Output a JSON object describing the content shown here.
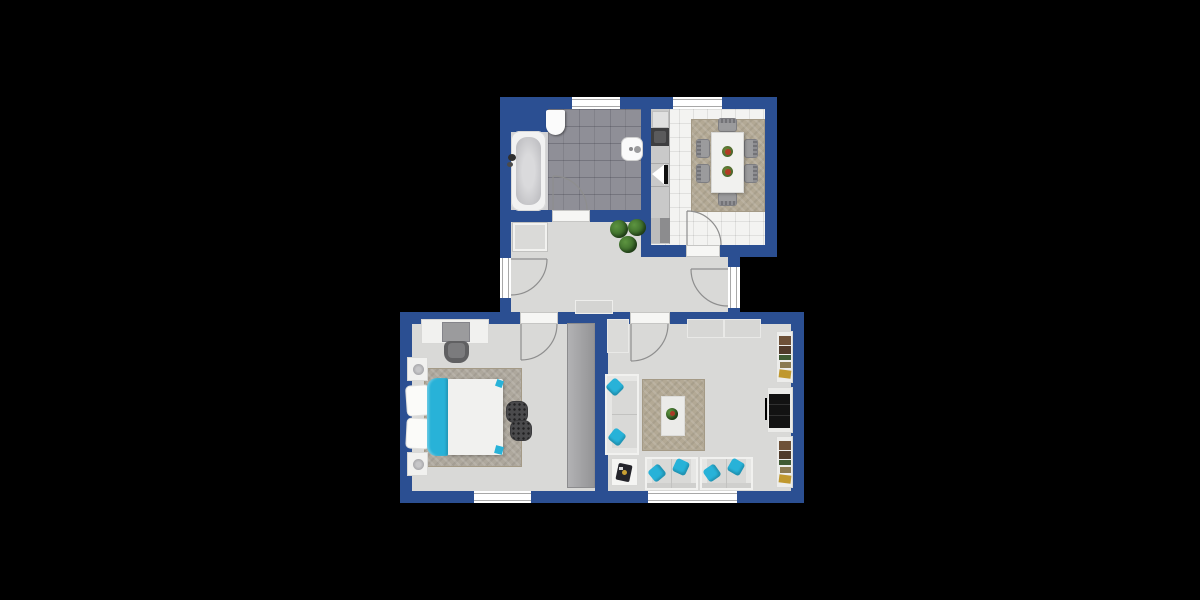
{
  "palette": {
    "background": "#000000",
    "wall": "#2b4f92",
    "floor": "#d9d9d7",
    "bath_tile": "#8f8f97",
    "kitchen_tile": "#f3f3f1",
    "rug": "#b3a995",
    "accent_cyan": "#28b2d8",
    "white_furniture": "#f1f1ef",
    "sofa_gray": "#d9d9d7",
    "dark_gray": "#4a4a4c",
    "plant_green": "#2f5c22",
    "wood_brown": "#6e5138",
    "tv_black": "#121212"
  },
  "plan": {
    "type": "apartment-floor-plan",
    "wall_color_name": "navy-blue",
    "rooms": [
      {
        "name": "bathroom",
        "position": "top-left",
        "floor": "dark-gray-tile",
        "fixtures": [
          "bathtub",
          "pedestal-sink",
          "wall-sink"
        ],
        "windows": 1,
        "doors": 1
      },
      {
        "name": "kitchen-dining",
        "position": "top-right",
        "floor": "white-tile",
        "fixtures": [
          "counter-run",
          "fridge",
          "stove",
          "sink",
          "appliance",
          "dining-table",
          "chairs-x6",
          "table-decor-x2",
          "area-rug"
        ],
        "windows": 1,
        "doors": 1
      },
      {
        "name": "hallway",
        "position": "center",
        "floor": "light-gray",
        "fixtures": [
          "plants-x3",
          "sideboard",
          "storage-cabinet"
        ],
        "exterior_doors": 2
      },
      {
        "name": "bedroom",
        "position": "bottom-left",
        "floor": "light-gray",
        "fixtures": [
          "double-bed",
          "cyan-blanket",
          "pillows-x2",
          "nightstands-x2",
          "lamps-x2",
          "area-rug",
          "poufs-x2",
          "wardrobe",
          "desk",
          "monitor",
          "desk-chair"
        ],
        "windows": 1,
        "doors": 1
      },
      {
        "name": "living-room",
        "position": "bottom-right",
        "floor": "light-gray",
        "fixtures": [
          "wall-sofa",
          "loveseats-x2",
          "cyan-pillows-x6",
          "side-table",
          "area-rug",
          "white-mat",
          "plant-decor",
          "tv",
          "tv-console",
          "bookshelves-x2",
          "cabinets-x3"
        ],
        "windows": 1,
        "doors": 1
      }
    ]
  }
}
